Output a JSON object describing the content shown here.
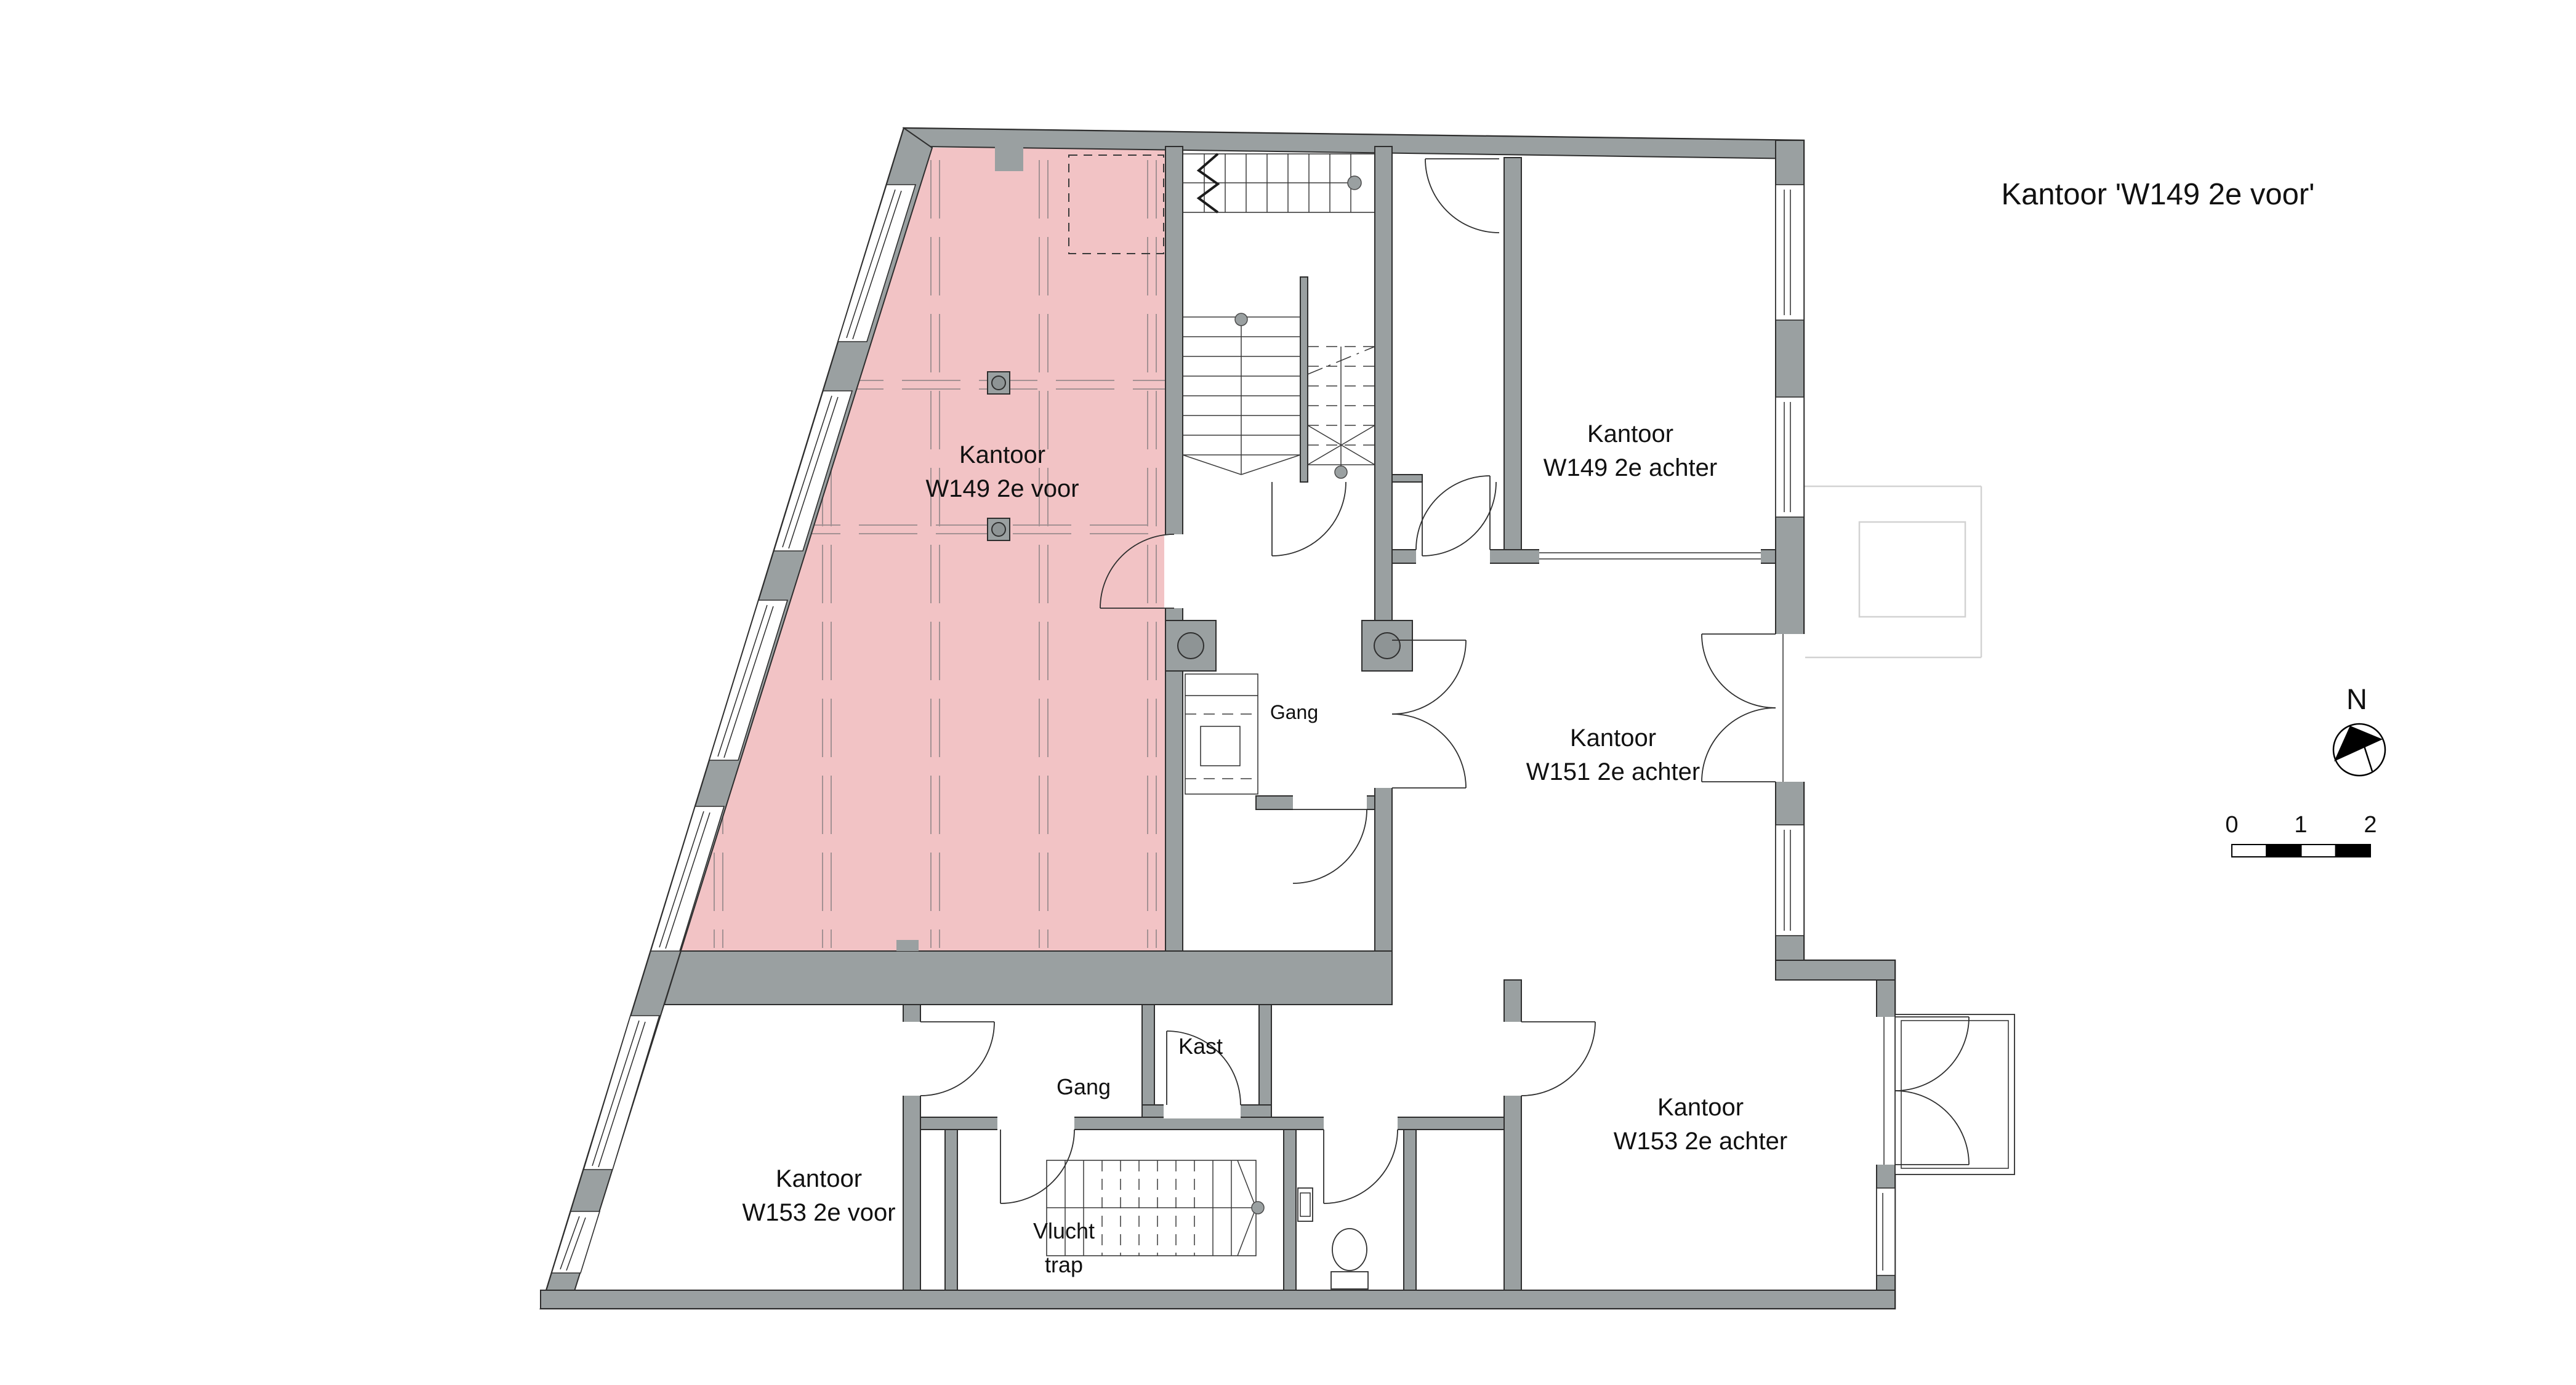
{
  "title": "Kantoor 'W149 2e voor'",
  "rooms": {
    "w149_voor": {
      "line1": "Kantoor",
      "line2": "W149 2e voor",
      "highlighted": true
    },
    "w149_achter": {
      "line1": "Kantoor",
      "line2": "W149 2e achter"
    },
    "w151_achter": {
      "line1": "Kantoor",
      "line2": "W151 2e achter"
    },
    "w153_voor": {
      "line1": "Kantoor",
      "line2": "W153 2e voor"
    },
    "w153_achter": {
      "line1": "Kantoor",
      "line2": "W153 2e achter"
    },
    "gang_central": {
      "label": "Gang"
    },
    "gang_lower": {
      "label": "Gang"
    },
    "kast": {
      "label": "Kast"
    },
    "vluchttrap": {
      "line1": "Vlucht",
      "line2": "trap"
    }
  },
  "compass": {
    "label": "N"
  },
  "scale_bar": {
    "tick0": "0",
    "tick1": "1",
    "tick2": "2"
  },
  "colors": {
    "highlight_pink": "#F2C3C5",
    "wall_gray": "#9AA0A1",
    "outline": "#2E2E2E",
    "ghost_gray": "#D2D2D2"
  }
}
